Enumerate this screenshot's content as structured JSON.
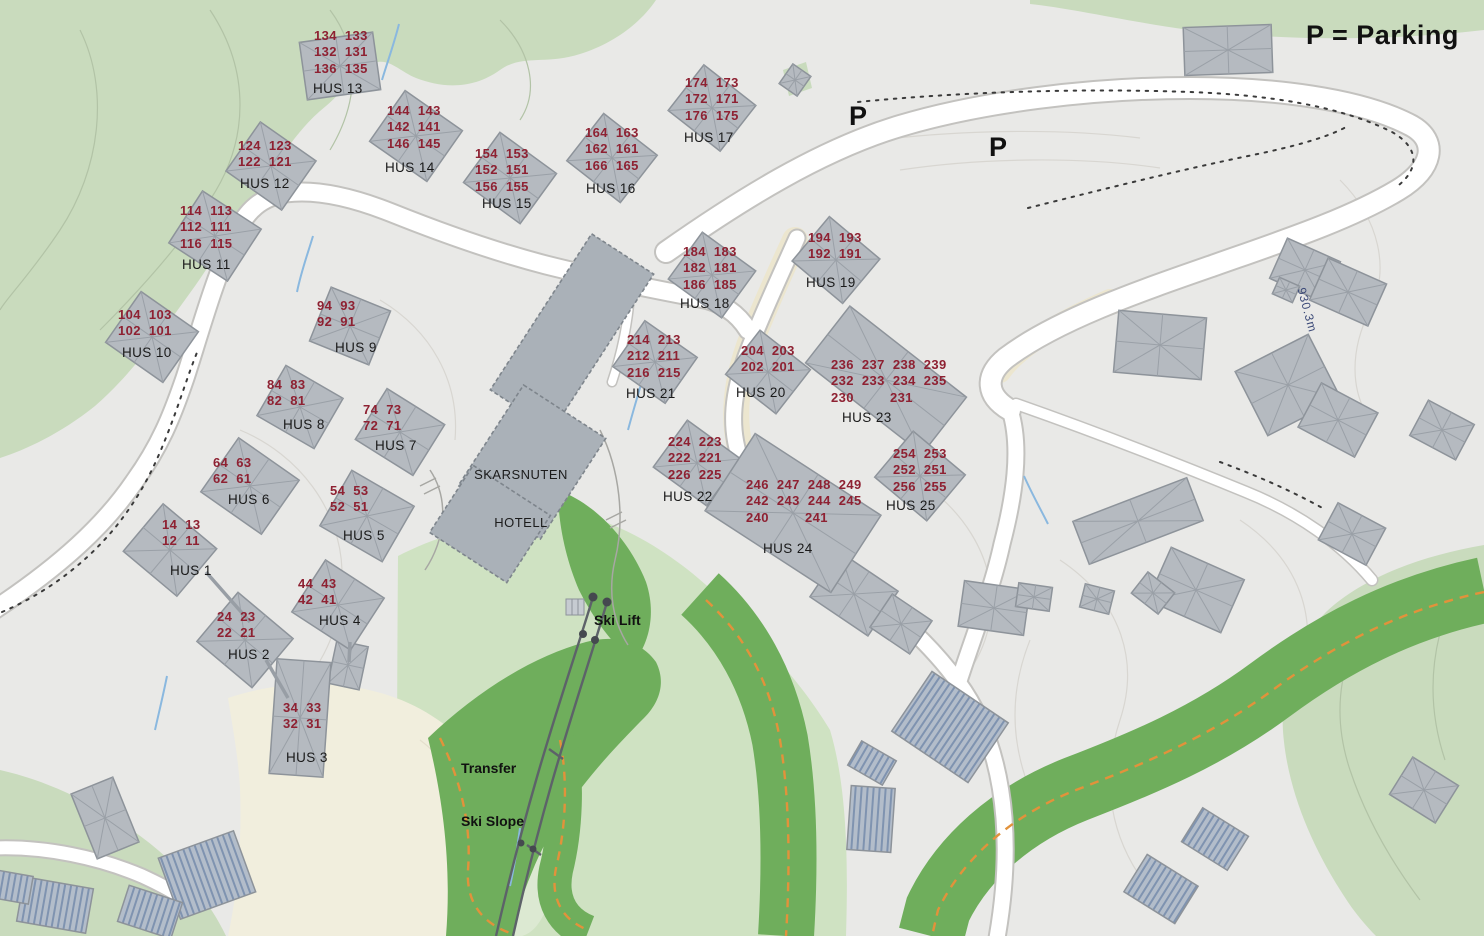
{
  "legend": {
    "text": "P = Parking"
  },
  "parking_markers": [
    {
      "label": "P"
    },
    {
      "label": "P"
    }
  ],
  "hotel": {
    "line1": "SKARSNUTEN",
    "line2": "HOTELL"
  },
  "ski_lift": {
    "label": "Ski Lift"
  },
  "transfer_slope": {
    "line1": "Transfer",
    "line2": "Ski Slope"
  },
  "elevation": {
    "text": "930.3m"
  },
  "colors": {
    "unit_number": "#8e2132",
    "house_label": "#1a1a1a",
    "slope_green": "#6fae5c",
    "forest_green": "#c9dbbd",
    "trail_orange": "#e2923b",
    "hotel_gray": "#aab1b8",
    "map_background": "#e9e9e7"
  },
  "houses": [
    {
      "name": "HUS 1",
      "rows": [
        "14  13",
        "12  11"
      ]
    },
    {
      "name": "HUS 2",
      "rows": [
        "24  23",
        "22  21"
      ]
    },
    {
      "name": "HUS 3",
      "rows": [
        "34  33",
        "32  31"
      ]
    },
    {
      "name": "HUS 4",
      "rows": [
        "44  43",
        "42  41"
      ]
    },
    {
      "name": "HUS 5",
      "rows": [
        "54  53",
        "52  51"
      ]
    },
    {
      "name": "HUS 6",
      "rows": [
        "64  63",
        "62  61"
      ]
    },
    {
      "name": "HUS 7",
      "rows": [
        "74  73",
        "72  71"
      ]
    },
    {
      "name": "HUS 8",
      "rows": [
        "84  83",
        "82  81"
      ]
    },
    {
      "name": "HUS 9",
      "rows": [
        "94  93",
        "92  91"
      ]
    },
    {
      "name": "HUS 10",
      "rows": [
        "104  103",
        "102  101"
      ]
    },
    {
      "name": "HUS 11",
      "rows": [
        "114  113",
        "112  111",
        "116  115"
      ]
    },
    {
      "name": "HUS 12",
      "rows": [
        "124  123",
        "122  121"
      ]
    },
    {
      "name": "HUS 13",
      "rows": [
        "134  133",
        "132  131",
        "136  135"
      ]
    },
    {
      "name": "HUS 14",
      "rows": [
        "144  143",
        "142  141",
        "146  145"
      ]
    },
    {
      "name": "HUS 15",
      "rows": [
        "154  153",
        "152  151",
        "156  155"
      ]
    },
    {
      "name": "HUS 16",
      "rows": [
        "164  163",
        "162  161",
        "166  165"
      ]
    },
    {
      "name": "HUS 17",
      "rows": [
        "174  173",
        "172  171",
        "176  175"
      ]
    },
    {
      "name": "HUS 18",
      "rows": [
        "184  183",
        "182  181",
        "186  185"
      ]
    },
    {
      "name": "HUS 19",
      "rows": [
        "194  193",
        "192  191"
      ]
    },
    {
      "name": "HUS 20",
      "rows": [
        "204  203",
        "202  201"
      ]
    },
    {
      "name": "HUS 21",
      "rows": [
        "214  213",
        "212  211",
        "216  215"
      ]
    },
    {
      "name": "HUS 22",
      "rows": [
        "224  223",
        "222  221",
        "226  225"
      ]
    },
    {
      "name": "HUS 23",
      "rows": [
        "236  237  238  239",
        "232  233  234  235",
        "230         231"
      ]
    },
    {
      "name": "HUS 24",
      "rows": [
        "246  247  248  249",
        "242  243  244  245",
        "240         241"
      ]
    },
    {
      "name": "HUS 25",
      "rows": [
        "254  253",
        "252  251",
        "256  255"
      ]
    }
  ]
}
